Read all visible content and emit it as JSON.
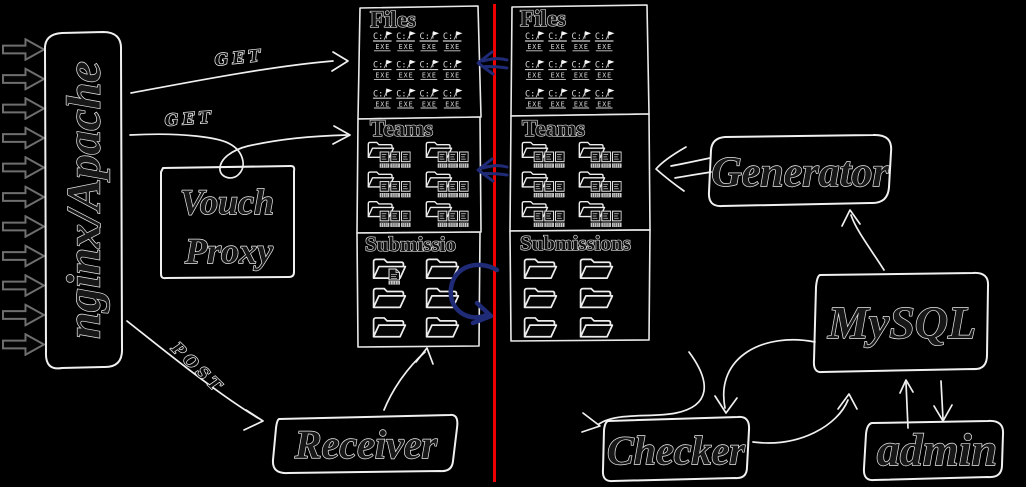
{
  "canvas": {
    "background": "#000000",
    "divider_color": "#ee0000",
    "sync_color": "#1f2b77",
    "ink_color": "#f0f0f0"
  },
  "nodes": {
    "ingress": {
      "label": "nginx/Apache"
    },
    "vouch_proxy": {
      "line1": "Vouch",
      "line2": "Proxy"
    },
    "receiver": {
      "label": "Receiver"
    },
    "generator": {
      "label": "Generator"
    },
    "mysql": {
      "label": "MySQL"
    },
    "checker": {
      "label": "Checker"
    },
    "admin": {
      "label": "admin"
    }
  },
  "edge_labels": {
    "get_files": "GET",
    "get_teams": "GET",
    "post": "POST"
  },
  "columns": {
    "left": {
      "files": {
        "title": "Files",
        "rows": 3,
        "cols": 4
      },
      "teams": {
        "title": "Teams",
        "rows": 3,
        "cols": 2
      },
      "submissions": {
        "title": "Submissio",
        "rows": 3,
        "cols": 2,
        "has_new_file_badge": true
      }
    },
    "right": {
      "files": {
        "title": "Files",
        "rows": 3,
        "cols": 4
      },
      "teams": {
        "title": "Teams",
        "rows": 3,
        "cols": 2
      },
      "submissions": {
        "title": "Submissions",
        "rows": 3,
        "cols": 2
      }
    }
  },
  "icons": {
    "exe_drive": "C:/",
    "exe_label": "EXE"
  },
  "ingress": {
    "arrow_count": 11
  }
}
